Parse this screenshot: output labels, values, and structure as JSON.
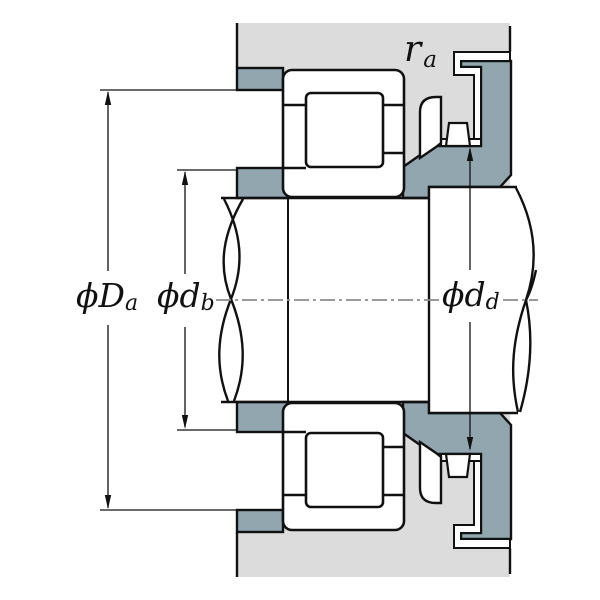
{
  "drawing": {
    "title": "bearing-mounting-cross-section",
    "labels": {
      "ra": {
        "main": "r",
        "sub": "a"
      },
      "Da": {
        "main": "ϕD",
        "sub": "a"
      },
      "db": {
        "main": "ϕd",
        "sub": "b"
      },
      "dd": {
        "main": "ϕd",
        "sub": "d"
      }
    },
    "colors": {
      "housing": "#dcdcdc",
      "abutment": "#92a6b0",
      "outline": "#111111",
      "centerline": "#8c8c8c",
      "part_fill": "#ffffff"
    }
  }
}
